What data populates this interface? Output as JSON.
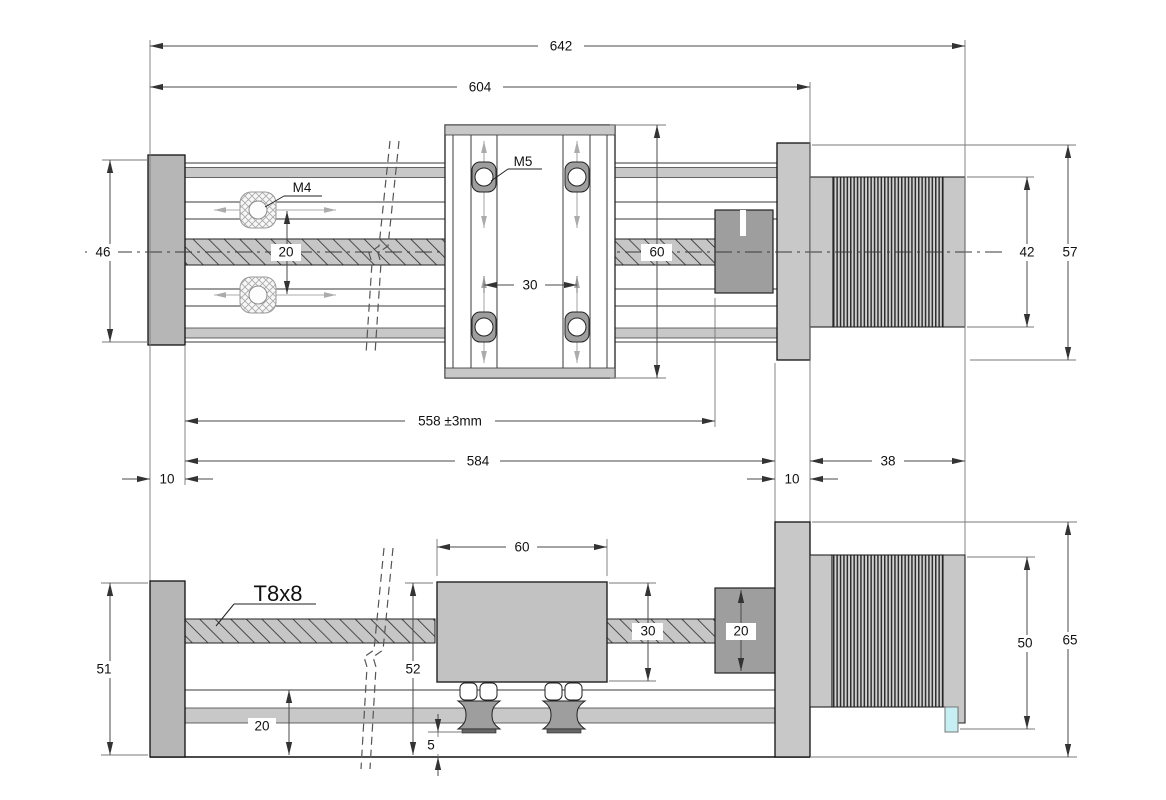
{
  "plan": {
    "overall_length": "642",
    "body_length": "604",
    "end_block_height": "46",
    "slot_thread": "M4",
    "slot_spacing": "20",
    "carriage_thread": "M5",
    "carriage_hole_spacing": "30",
    "carriage_length": "60",
    "motor_body_width": "42",
    "motor_flange_width": "57",
    "travel_length": "558 ±3mm",
    "rail_length": "584",
    "left_offset": "10",
    "right_offset": "10",
    "motor_length": "38"
  },
  "side": {
    "end_block_height": "51",
    "leadscrew_type": "T8x8",
    "carriage_length": "60",
    "carriage_height": "30",
    "coupler_height": "20",
    "carriage_overall_height": "52",
    "base_section_height": "20",
    "wheel_clearance": "5",
    "motor_height": "50",
    "overall_height": "65"
  },
  "colors": {
    "part_light": "#c8c8c8",
    "part_medium": "#b6b6b6",
    "part_dark": "#9e9e9e",
    "connector_cyan": "#c5eff3",
    "outline": "#1c1c1c",
    "dimension": "#4a4a4a"
  }
}
